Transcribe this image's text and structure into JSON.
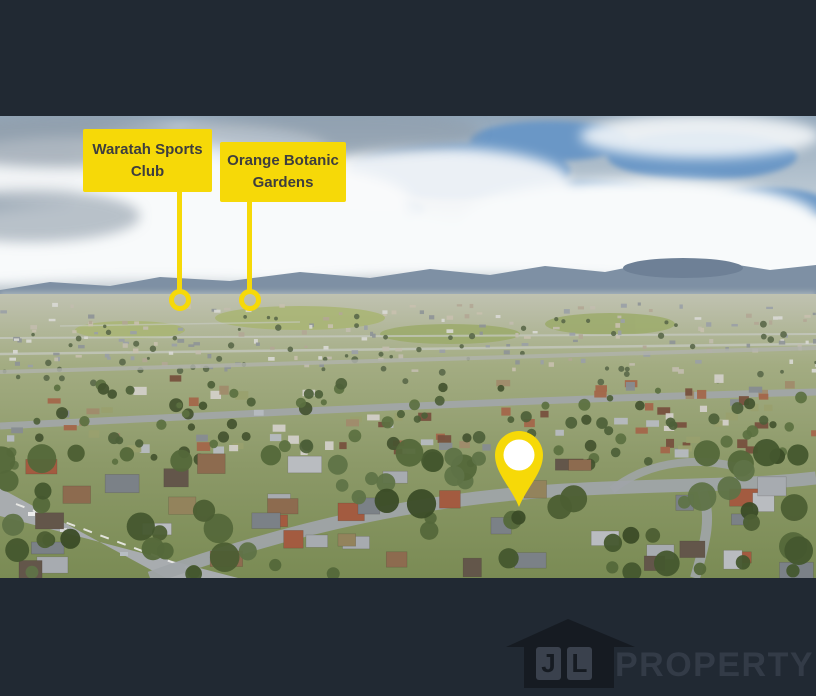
{
  "callouts": [
    {
      "label": "Waratah Sports Club"
    },
    {
      "label": "Orange Botanic Gardens"
    }
  ],
  "marker": {
    "icon": "map-pin-icon"
  },
  "logo": {
    "letter_j": "J",
    "letter_l": "L",
    "wordmark": "PROPERTY",
    "icon": "house-icon"
  },
  "colors": {
    "accent_yellow": "#F6D908",
    "background": "#212933",
    "callout_text": "#3E3E3E",
    "wordmark_text": "#333B47"
  }
}
